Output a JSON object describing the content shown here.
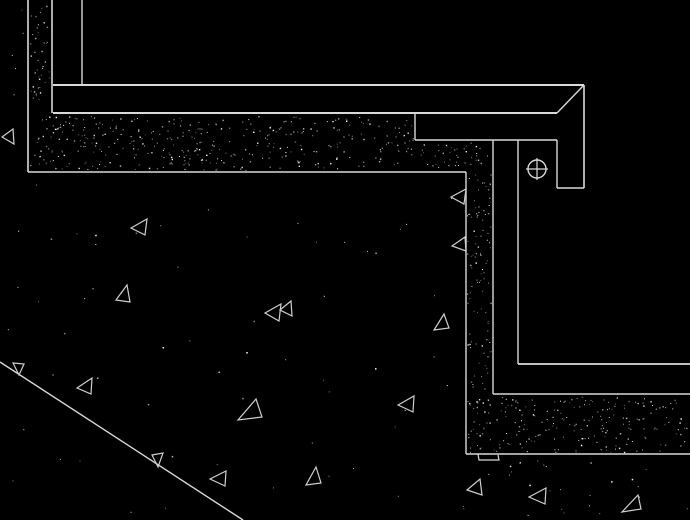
{
  "canvas": {
    "width": 690,
    "height": 520,
    "background_color": "#000000",
    "line_color": "#d9d9d9",
    "hatch_dot_color": "#ffffff",
    "triangle_color": "#cfcfcf",
    "seed": 1337
  },
  "drawing": {
    "lines": [
      {
        "name": "wall-outer-face-line",
        "x1": 28,
        "y1": 0,
        "x2": 28,
        "y2": 172,
        "w": 1.6
      },
      {
        "name": "hatch-bottom-edge-line",
        "x1": 28,
        "y1": 172,
        "x2": 466,
        "y2": 172,
        "w": 1.6
      },
      {
        "name": "hatch-inner-vertical-line",
        "x1": 466,
        "y1": 172,
        "x2": 466,
        "y2": 454,
        "w": 1.4
      },
      {
        "name": "lower-hatch-bottom-line",
        "x1": 466,
        "y1": 454,
        "x2": 690,
        "y2": 454,
        "w": 1.6
      },
      {
        "name": "wall-structural-face-line",
        "x1": 52,
        "y1": 0,
        "x2": 52,
        "y2": 113,
        "w": 1.6
      },
      {
        "name": "wall-finish-face-line",
        "x1": 82,
        "y1": 0,
        "x2": 82,
        "y2": 85,
        "w": 1.4
      },
      {
        "name": "tread-top-surface-line",
        "x1": 53,
        "y1": 85,
        "x2": 584,
        "y2": 85,
        "w": 2
      },
      {
        "name": "tread-underside-line",
        "x1": 53,
        "y1": 113,
        "x2": 557,
        "y2": 113,
        "w": 2
      },
      {
        "name": "nosing-chamfer-line",
        "x1": 584,
        "y1": 85,
        "x2": 557,
        "y2": 113,
        "w": 1.4
      },
      {
        "name": "nosing-outer-face-line",
        "x1": 584,
        "y1": 85,
        "x2": 584,
        "y2": 188,
        "w": 1.6
      },
      {
        "name": "nosing-inner-drop-line",
        "x1": 557,
        "y1": 140,
        "x2": 557,
        "y2": 188,
        "w": 1.4
      },
      {
        "name": "nosing-drip-bottom-line",
        "x1": 557,
        "y1": 188,
        "x2": 584,
        "y2": 188,
        "w": 1.4
      },
      {
        "name": "nosing-left-joint-line",
        "x1": 415,
        "y1": 113,
        "x2": 415,
        "y2": 140,
        "w": 1.4
      },
      {
        "name": "nosing-underside-line",
        "x1": 415,
        "y1": 140,
        "x2": 557,
        "y2": 140,
        "w": 1.6
      },
      {
        "name": "riser-finish-face-line",
        "x1": 518,
        "y1": 140,
        "x2": 518,
        "y2": 364,
        "w": 1.4
      },
      {
        "name": "riser-concrete-face-line",
        "x1": 493,
        "y1": 140,
        "x2": 493,
        "y2": 394,
        "w": 1.4
      },
      {
        "name": "lower-tread-top-line",
        "x1": 518,
        "y1": 364,
        "x2": 690,
        "y2": 364,
        "w": 1.8
      },
      {
        "name": "lower-tread-underside-line",
        "x1": 493,
        "y1": 394,
        "x2": 690,
        "y2": 394,
        "w": 1.6
      },
      {
        "name": "grade-slope-line",
        "x1": 0,
        "y1": 362,
        "x2": 243,
        "y2": 520,
        "w": 1.4
      }
    ],
    "polylines": [
      {
        "name": "break-notch-mark",
        "points": "478,454 479,460 499,460 498,455"
      }
    ],
    "aggregate_triangles": [
      {
        "name": "aggregate-triangle",
        "points": "2,137 13,129 14,144"
      },
      {
        "name": "aggregate-triangle",
        "points": "131,228 147,219 145,235"
      },
      {
        "name": "aggregate-triangle",
        "points": "116,300 127,285 130,302"
      },
      {
        "name": "aggregate-triangle",
        "points": "265,313 281,304 279,321"
      },
      {
        "name": "aggregate-triangle",
        "points": "280,310 291,301 292,316"
      },
      {
        "name": "aggregate-triangle",
        "points": "451,197 466,189 464,204"
      },
      {
        "name": "aggregate-triangle",
        "points": "452,246 465,237 466,251"
      },
      {
        "name": "aggregate-triangle",
        "points": "444,314 434,330 449,328"
      },
      {
        "name": "aggregate-triangle",
        "points": "13,363 24,364 19,375"
      },
      {
        "name": "aggregate-triangle",
        "points": "77,388 92,378 91,394"
      },
      {
        "name": "aggregate-triangle",
        "points": "152,455 163,453 158,467"
      },
      {
        "name": "aggregate-triangle",
        "points": "210,479 226,471 225,486"
      },
      {
        "name": "aggregate-triangle",
        "points": "256,399 238,420 262,417"
      },
      {
        "name": "aggregate-triangle",
        "points": "398,405 414,396 413,412"
      },
      {
        "name": "aggregate-triangle",
        "points": "316,467 306,485 321,483"
      },
      {
        "name": "aggregate-triangle",
        "points": "467,490 480,479 482,495"
      },
      {
        "name": "aggregate-triangle",
        "points": "529,497 546,488 545,504"
      },
      {
        "name": "aggregate-triangle",
        "points": "638,495 622,512 641,509"
      }
    ],
    "anchor_symbol": {
      "name": "anchor-bolt-icon",
      "cx": 537,
      "cy": 169,
      "r": 9,
      "cross_overhang": 2
    },
    "hatch_regions": [
      {
        "name": "wall-concrete-hatch",
        "x": 30,
        "y": 2,
        "w": 21,
        "h": 111,
        "density": 0.018
      },
      {
        "name": "slab-concrete-hatch",
        "x": 30,
        "y": 116,
        "w": 385,
        "h": 55,
        "density": 0.018
      },
      {
        "name": "slab-corner-concrete-hatch",
        "x": 416,
        "y": 142,
        "w": 76,
        "h": 29,
        "density": 0.018
      },
      {
        "name": "riser-concrete-hatch",
        "x": 467,
        "y": 171,
        "w": 25,
        "h": 222,
        "density": 0.018
      },
      {
        "name": "lower-step-concrete-hatch",
        "x": 467,
        "y": 396,
        "w": 221,
        "h": 57,
        "density": 0.018
      }
    ],
    "sparse_dot_regions": [
      {
        "name": "soil-speckle-main",
        "x": 4,
        "y": 178,
        "w": 450,
        "h": 335,
        "count": 58
      },
      {
        "name": "soil-speckle-lower",
        "x": 460,
        "y": 458,
        "w": 228,
        "h": 58,
        "count": 26
      },
      {
        "name": "soil-speckle-top-left",
        "x": 2,
        "y": 8,
        "w": 24,
        "h": 160,
        "count": 6
      }
    ]
  }
}
